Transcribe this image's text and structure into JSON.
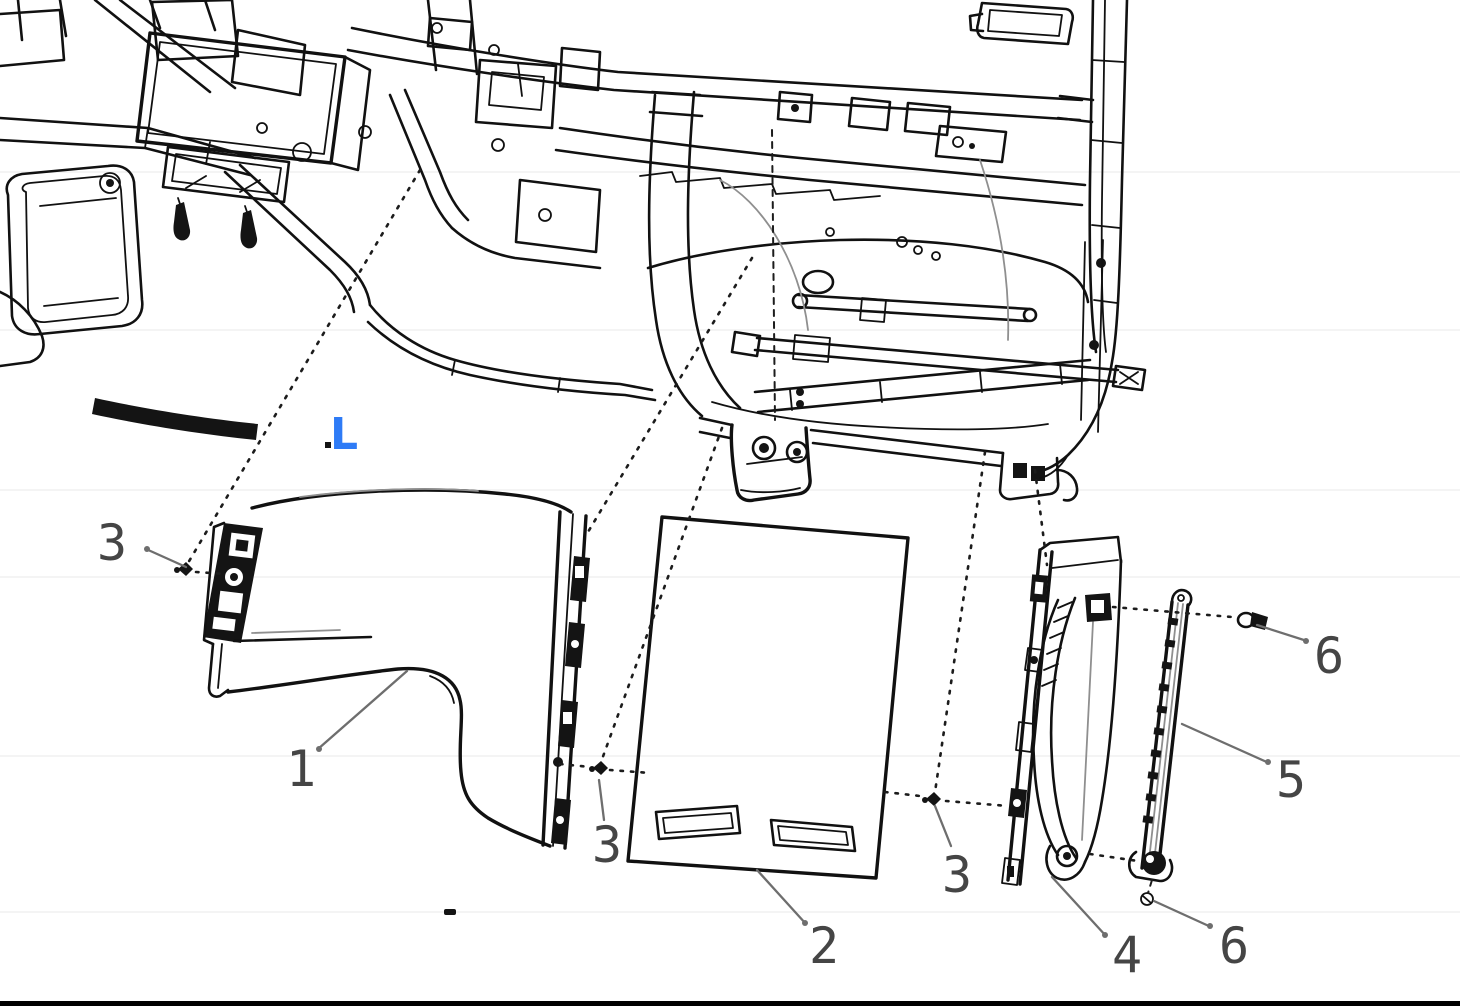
{
  "diagram": {
    "kind": "exploded-parts-diagram",
    "view_label": "L",
    "callouts": [
      {
        "id": "3-upper-left",
        "label": "3"
      },
      {
        "id": "1-panel",
        "label": "1"
      },
      {
        "id": "3-lower-center",
        "label": "3"
      },
      {
        "id": "2-panel",
        "label": "2"
      },
      {
        "id": "3-lower-right",
        "label": "3"
      },
      {
        "id": "4-bracket",
        "label": "4"
      },
      {
        "id": "6-lower",
        "label": "6"
      },
      {
        "id": "5-rail",
        "label": "5"
      },
      {
        "id": "6-upper",
        "label": "6"
      }
    ],
    "colors": {
      "background": "#ffffff",
      "line": "#111111",
      "leader": "#6e6e6e",
      "callout_text": "#454545",
      "view_label": "#2e7bf6",
      "bottom_rule": "#000000"
    }
  }
}
